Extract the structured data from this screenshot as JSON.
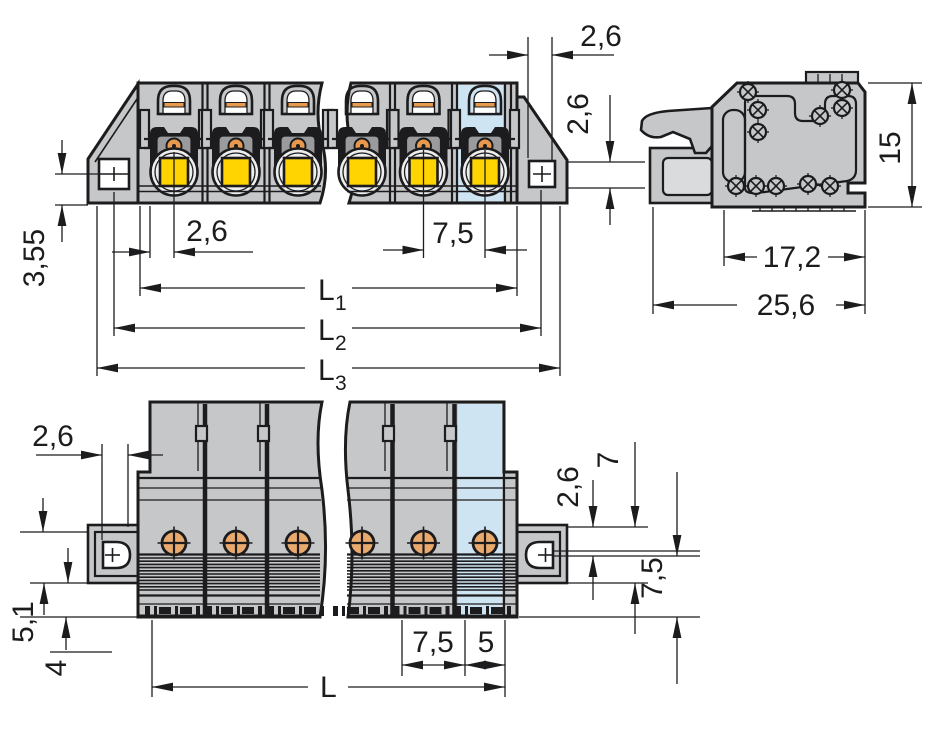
{
  "drawing": {
    "title": "connector-dimensional-drawing",
    "views": [
      "front-view",
      "side-view",
      "bottom-view"
    ]
  },
  "colors": {
    "outline": "#1c1c1e",
    "body_gray": "#c6c7c9",
    "highlight_blue": "#cfe4f2",
    "button_yellow": "#ffd400",
    "contact_orange": "#e79a4e",
    "white": "#ffffff"
  },
  "dims": {
    "front_pole_offset": "2,6",
    "front_pitch": "7,5",
    "front_l1_base": "L",
    "front_l1_sub": "1",
    "front_l2_base": "L",
    "front_l2_sub": "2",
    "front_l3_base": "L",
    "front_l3_sub": "3",
    "front_flange_height": "3,55",
    "front_end_offset": "2,6",
    "front_screw_band": "2,6",
    "side_height": "15",
    "side_body_depth": "17,2",
    "side_total_depth": "25,6",
    "bottom_screw_offset": "2,6",
    "bottom_collar_height": "5,1",
    "bottom_pin_length": "4",
    "bottom_pitch": "7,5",
    "bottom_end_width": "5",
    "bottom_length": "L",
    "bottom_strip": "2,6",
    "bottom_flange_height": "7",
    "bottom_flange_total": "7,5"
  }
}
